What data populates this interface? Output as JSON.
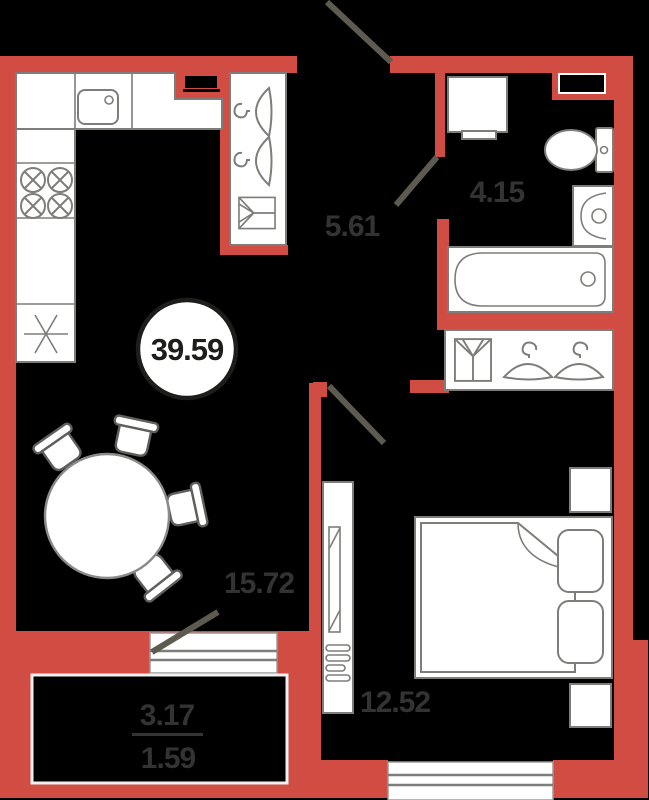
{
  "colors": {
    "background": "#000000",
    "wall": "#d14d43",
    "furniture_fill": "#ffffff",
    "furniture_outline": "#7d7d7a",
    "door_swing": "#5d5a50",
    "room_label": "#333333",
    "total_badge_text": "#1d1d1b",
    "balcony_border": "#f0f0f0"
  },
  "total_area_badge": {
    "value": "39.59"
  },
  "rooms": {
    "hallway": {
      "area": "5.61"
    },
    "bathroom": {
      "area": "4.15"
    },
    "living_kitchen": {
      "area": "15.72"
    },
    "bedroom": {
      "area": "12.52"
    },
    "balcony": {
      "area_full": "3.17",
      "area_reduced": "1.59"
    }
  },
  "fixtures": [
    "kitchen-sink-icon",
    "stove-burner-icon",
    "refrigerator-snowflake-icon",
    "hanger-icon",
    "shirt-icon",
    "washing-machine-icon",
    "toilet-icon",
    "washbasin-icon",
    "bathtub-icon",
    "dining-table-icon",
    "chair-icon",
    "double-bed-icon",
    "pillow-icon",
    "nightstand-icon",
    "wardrobe-mirror-icon",
    "window-icon",
    "door-swing-icon",
    "vent-shaft-icon"
  ]
}
